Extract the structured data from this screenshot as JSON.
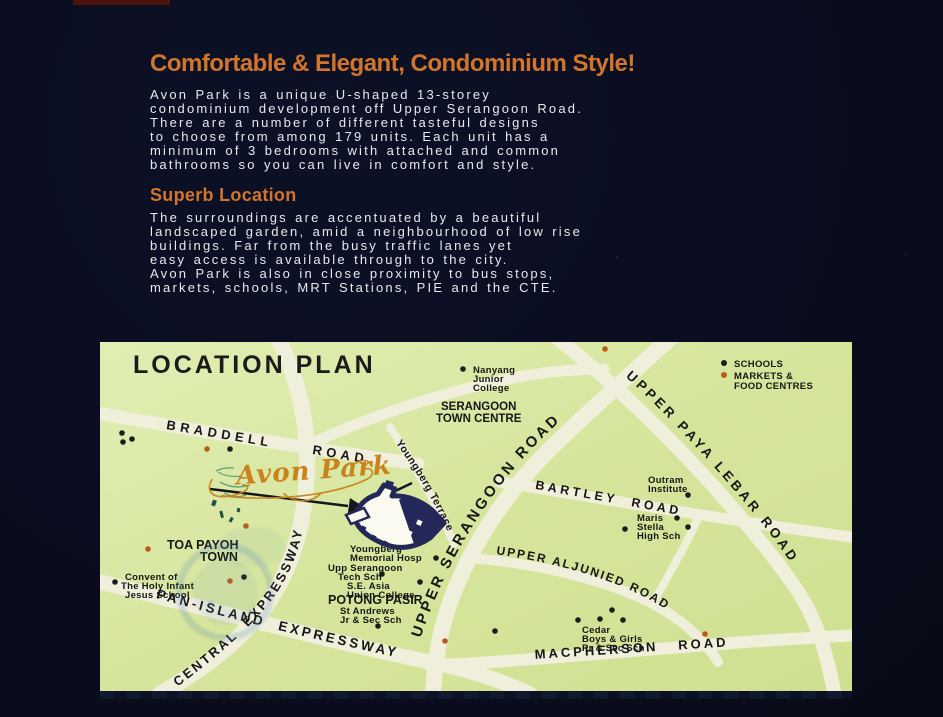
{
  "page": {
    "background": "#0a0d1f",
    "accent": "#d2752c"
  },
  "header": {
    "headline": "Comfortable & Elegant, Condominium Style!",
    "intro": "Avon Park is a unique U-shaped 13-storey\ncondominium development off Upper Serangoon Road.\nThere are a number of different tasteful designs\nto choose from among 179 units. Each unit has a\nminimum of 3 bedrooms with attached and common\nbathrooms so you can live in comfort and style.",
    "subheading": "Superb Location",
    "location_text": "The surroundings are accentuated by a beautiful\nlandscaped garden, amid a neighbourhood of low rise\nbuildings. Far from the busy traffic lanes yet\neasy access is available through to the city.\nAvon Park is also in close proximity to bus stops,\nmarkets, schools, MRT Stations, PIE and the CTE."
  },
  "map": {
    "title": "LOCATION PLAN",
    "project_label": "Avon Park",
    "legend": {
      "schools": "SCHOOLS",
      "markets_line1": "MARKETS &",
      "markets_line2": "FOOD CENTRES",
      "school_dot_color": "#1c1c1c",
      "market_dot_color": "#b85c1e"
    },
    "roads": {
      "braddell": "BRADDELL     ROAD",
      "central_expressway": "CENTRAL  EXPRESSWAY",
      "pan_island_expressway": "PAN-ISLAND  EXPRESSWAY",
      "upper_serangoon": "UPPER SERANGOON ROAD",
      "upper_paya_lebar": "UPPER PAYA LEBAR ROAD",
      "bartley": "BARTLEY  ROAD",
      "upper_aljunied": "UPPER ALJUNIED ROAD",
      "macpherson": "MACPHERSON   ROAD",
      "youngberg_terrace": "Youngberg Terrace"
    },
    "areas": {
      "serangoon_town_centre": [
        "SERANGOON",
        "TOWN CENTRE"
      ],
      "toa_payoh_town": [
        "TOA PAYOH",
        "TOWN"
      ],
      "potong_pasir": "POTONG PASIR"
    },
    "places": {
      "nanyang": [
        "Nanyang",
        "Junior",
        "College"
      ],
      "outram": [
        "Outram",
        "Institute"
      ],
      "maris": [
        "Maris",
        "Stella",
        "High Sch"
      ],
      "youngberg_hosp": [
        "Youngberg",
        "Memorial Hosp"
      ],
      "upp_tech": [
        "Upp Serangoon",
        "Tech Sch"
      ],
      "se_asia": [
        "S.E. Asia",
        "Union College"
      ],
      "st_andrews": [
        "St Andrews",
        "Jr & Sec Sch"
      ],
      "convent": [
        "Convent of",
        "The Holy Infant",
        "Jesus School"
      ],
      "cedar": [
        "Cedar",
        "Boys & Girls",
        "Pr & Sec Sch"
      ]
    }
  }
}
